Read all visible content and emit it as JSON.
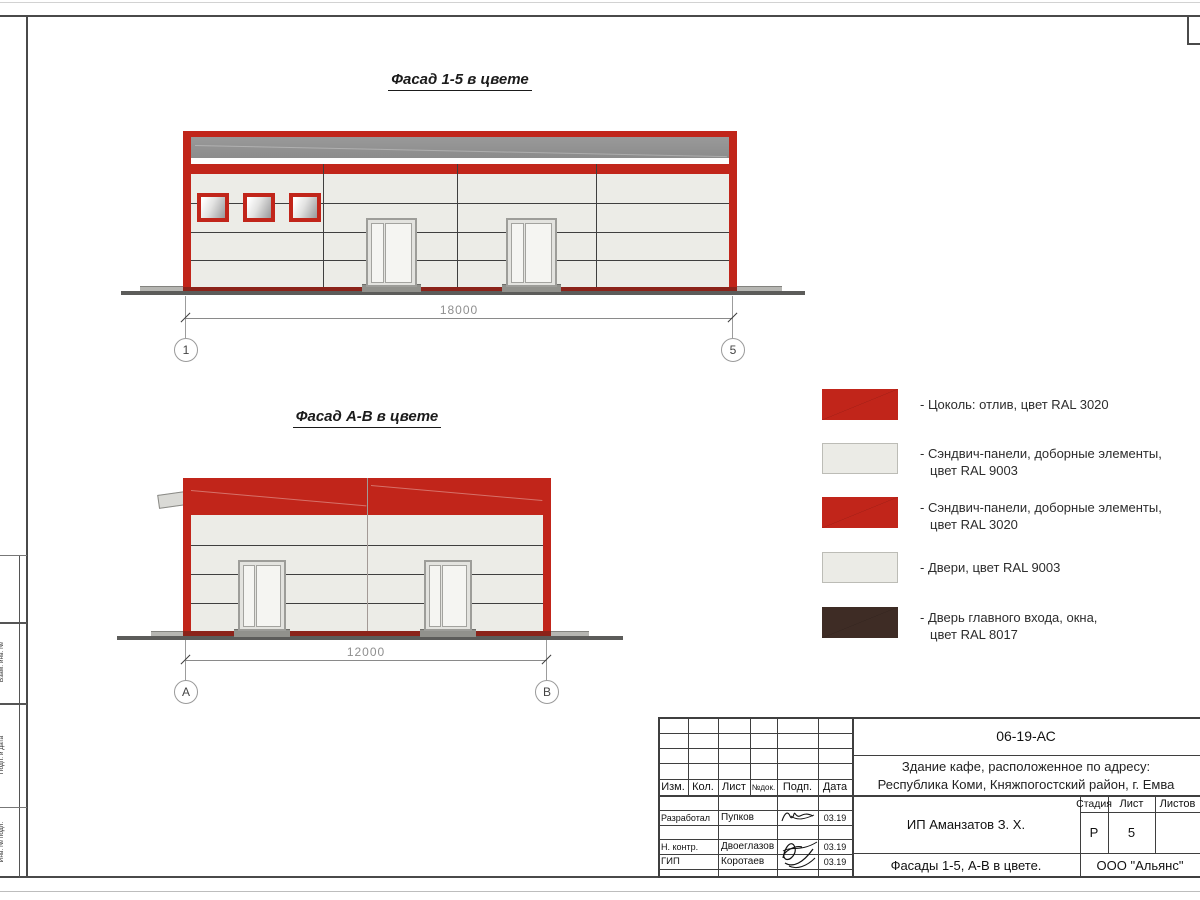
{
  "colors": {
    "red": "#C1251A",
    "red_dark": "#8B231A",
    "panel": "#ECECE7",
    "panel_joint": "#C9C9C3",
    "gray_band": "#8C8C8C",
    "brown": "#3E2C25",
    "ground_dark": "#5C5C5A",
    "ground_light": "#B6B6B2"
  },
  "frame": {
    "side_labels": [
      "Взам. инв. №",
      "Подп. и дата",
      "Инв. № подл."
    ]
  },
  "facade_top": {
    "title": "Фасад 1-5 в цвете",
    "dimension": "18000",
    "axis_left": "1",
    "axis_right": "5"
  },
  "facade_bottom": {
    "title": "Фасад А-В в цвете",
    "dimension": "12000",
    "axis_left": "А",
    "axis_right": "В"
  },
  "legend": {
    "items": [
      {
        "color": "#C1251A",
        "line1": "- Цоколь: отлив, цвет RAL 3020",
        "line2": ""
      },
      {
        "color": "#EBEBE6",
        "line1": "- Сэндвич-панели, доборные элементы,",
        "line2": "цвет RAL 9003"
      },
      {
        "color": "#C1251A",
        "line1": "- Сэндвич-панели, доборные элементы,",
        "line2": "цвет RAL 3020"
      },
      {
        "color": "#EBEBE6",
        "line1": "- Двери, цвет RAL 9003",
        "line2": ""
      },
      {
        "color": "#3E2C25",
        "line1": "- Дверь главного входа, окна,",
        "line2": "цвет RAL 8017"
      }
    ]
  },
  "title_block": {
    "doc_number": "06-19-АС",
    "project_line1": "Здание кафе, расположенное по адресу:",
    "project_line2": "Республика Коми, Княжпогостский район, г. Емва",
    "client": "ИП Аманзатов З. Х.",
    "sheet_title": "Фасады 1-5, А-В в цвете.",
    "company": "ООО \"Альянс\"",
    "stage_label": "Стадия",
    "sheet_label": "Лист",
    "sheets_label": "Листов",
    "stage_value": "Р",
    "sheet_value": "5",
    "header": [
      "Изм.",
      "Кол.",
      "Лист",
      "№док.",
      "Подп.",
      "Дата"
    ],
    "rows": [
      {
        "role": "Разработал",
        "name": "Пупков",
        "date": "03.19"
      },
      {
        "role": "Н. контр.",
        "name": "Двоеглазов",
        "date": "03.19"
      },
      {
        "role": "ГИП",
        "name": "Коротаев",
        "date": "03.19"
      }
    ]
  }
}
